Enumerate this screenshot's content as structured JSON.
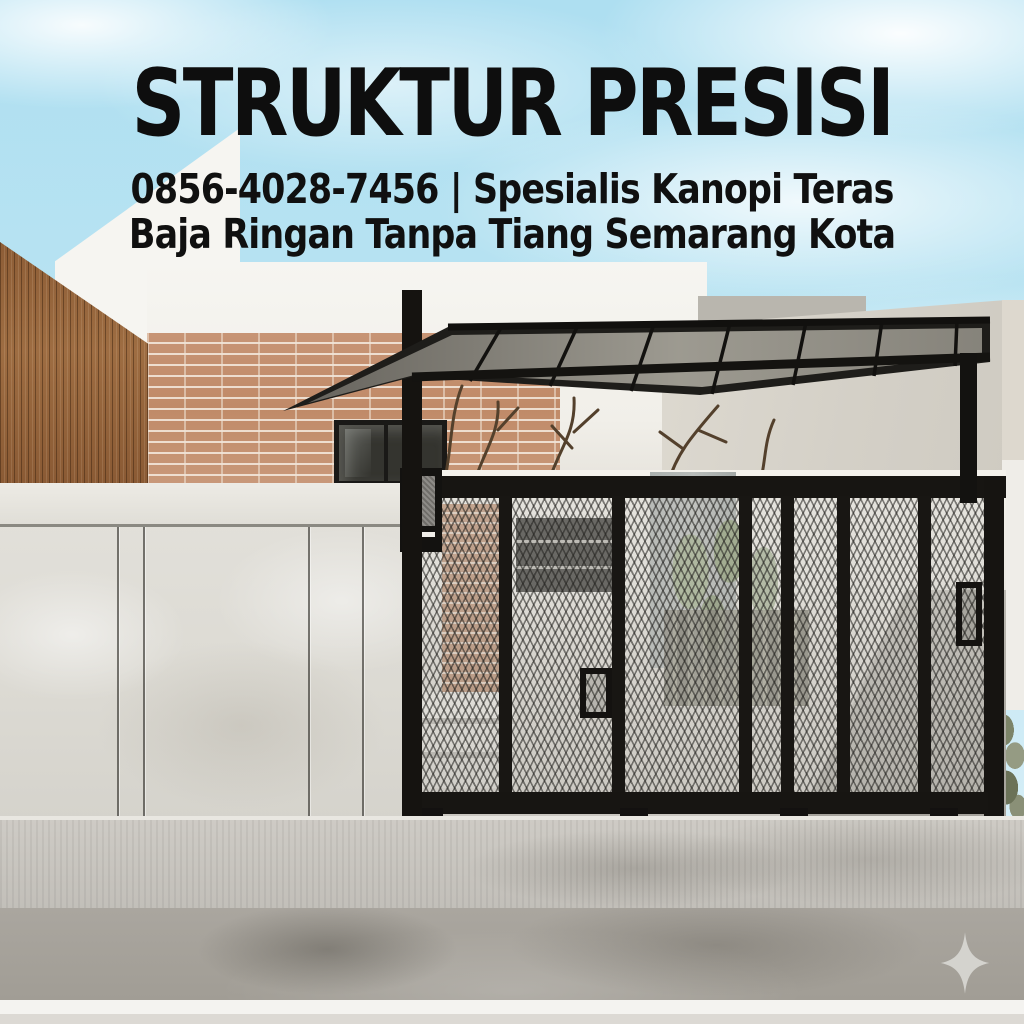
{
  "page": {
    "type": "promotional-social-image",
    "language": "Indonesian",
    "canvas_size": "1024x1024"
  },
  "overlay_text": {
    "headline": "STRUKTUR PRESISI",
    "subtitle_line_1": "0856-4028-7456 | Spesialis Kanopi Teras",
    "subtitle_line_2": "Baja Ringan Tanpa Tiang Semarang Kota",
    "phone_number": "0856-4028-7456",
    "service": "Spesialis Kanopi Teras Baja Ringan Tanpa Tiang",
    "location": "Semarang Kota",
    "text_color": "#0e0e0e"
  },
  "photo_scene": {
    "description": "Modern minimalist house facade: black expanded-metal sliding gate, cantilevered black steel canopy with polycarbonate roof, vertical wood slat wall, exposed brick wall with dry branches, polished concrete fence, gray driveway under soft blue sky",
    "sky_color": "#b5e1f0",
    "elements": [
      {
        "name": "wood-slat-wall",
        "color": "#95663c"
      },
      {
        "name": "brick-wall",
        "color": "#c4916f"
      },
      {
        "name": "brick-window",
        "color": "#2e2e2a"
      },
      {
        "name": "concrete-fence",
        "color": "#dedcd5"
      },
      {
        "name": "steel-gate-frame",
        "color": "#161512"
      },
      {
        "name": "gate-mesh-panels",
        "color": "#c6c5c0"
      },
      {
        "name": "canopy-frame",
        "color": "#1e1d1a"
      },
      {
        "name": "canopy-roof-glass",
        "color": "#8a8780"
      },
      {
        "name": "white-house-wall",
        "color": "#f4f3ef"
      },
      {
        "name": "right-building-wall",
        "color": "#d6d2c9"
      },
      {
        "name": "plant-leaves",
        "color": "#8e9c7c"
      },
      {
        "name": "driveway-road",
        "color": "#a9a59e"
      },
      {
        "name": "dry-branches",
        "color": "#53402c"
      }
    ]
  },
  "watermark": {
    "icon": "four-point-sparkle-icon",
    "color": "#d8d7d3",
    "position": "bottom-right"
  }
}
